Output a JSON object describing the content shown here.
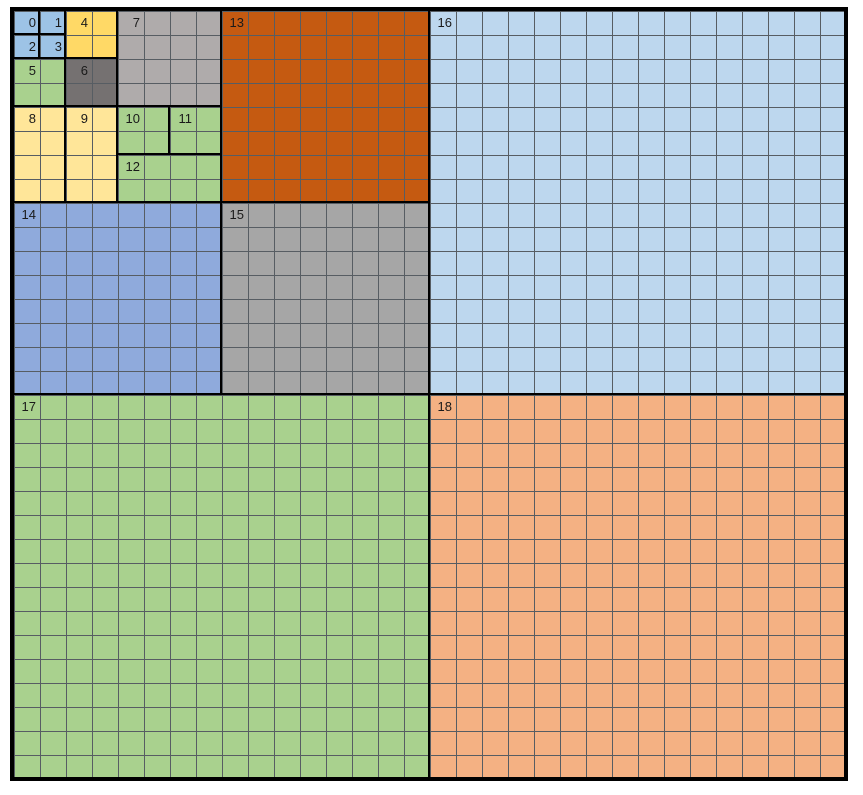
{
  "diagram": {
    "type": "quadtree-grid-decomposition",
    "grid": {
      "cols": 32,
      "rows": 32
    },
    "colors": {
      "background": "#ffffff",
      "gridline": "#575d63",
      "block_border": "#000000",
      "label_text": "#1a1a1a"
    },
    "blocks": [
      {
        "label": "0",
        "col": 0,
        "row": 0,
        "w": 1,
        "h": 1,
        "fill": "#9DC3E6"
      },
      {
        "label": "1",
        "col": 1,
        "row": 0,
        "w": 1,
        "h": 1,
        "fill": "#9DC3E6"
      },
      {
        "label": "2",
        "col": 0,
        "row": 1,
        "w": 1,
        "h": 1,
        "fill": "#9DC3E6"
      },
      {
        "label": "3",
        "col": 1,
        "row": 1,
        "w": 1,
        "h": 1,
        "fill": "#9DC3E6"
      },
      {
        "label": "4",
        "col": 2,
        "row": 0,
        "w": 2,
        "h": 2,
        "fill": "#FFD966"
      },
      {
        "label": "5",
        "col": 0,
        "row": 2,
        "w": 2,
        "h": 2,
        "fill": "#A9D18E"
      },
      {
        "label": "6",
        "col": 2,
        "row": 2,
        "w": 2,
        "h": 2,
        "fill": "#757171"
      },
      {
        "label": "7",
        "col": 4,
        "row": 0,
        "w": 4,
        "h": 4,
        "fill": "#AFABAB"
      },
      {
        "label": "8",
        "col": 0,
        "row": 4,
        "w": 2,
        "h": 4,
        "fill": "#FFE699"
      },
      {
        "label": "9",
        "col": 2,
        "row": 4,
        "w": 2,
        "h": 4,
        "fill": "#FFE699"
      },
      {
        "label": "10",
        "col": 4,
        "row": 4,
        "w": 2,
        "h": 2,
        "fill": "#A9D18E"
      },
      {
        "label": "11",
        "col": 6,
        "row": 4,
        "w": 2,
        "h": 2,
        "fill": "#A9D18E"
      },
      {
        "label": "12",
        "col": 4,
        "row": 6,
        "w": 4,
        "h": 2,
        "fill": "#A9D18E"
      },
      {
        "label": "13",
        "col": 8,
        "row": 0,
        "w": 8,
        "h": 8,
        "fill": "#C55A11"
      },
      {
        "label": "14",
        "col": 0,
        "row": 8,
        "w": 8,
        "h": 8,
        "fill": "#8FAADC"
      },
      {
        "label": "15",
        "col": 8,
        "row": 8,
        "w": 8,
        "h": 8,
        "fill": "#A6A6A6"
      },
      {
        "label": "16",
        "col": 16,
        "row": 0,
        "w": 16,
        "h": 16,
        "fill": "#BDD7EE"
      },
      {
        "label": "17",
        "col": 0,
        "row": 16,
        "w": 16,
        "h": 16,
        "fill": "#A9D18E"
      },
      {
        "label": "18",
        "col": 16,
        "row": 16,
        "w": 16,
        "h": 16,
        "fill": "#F4B183"
      }
    ]
  }
}
